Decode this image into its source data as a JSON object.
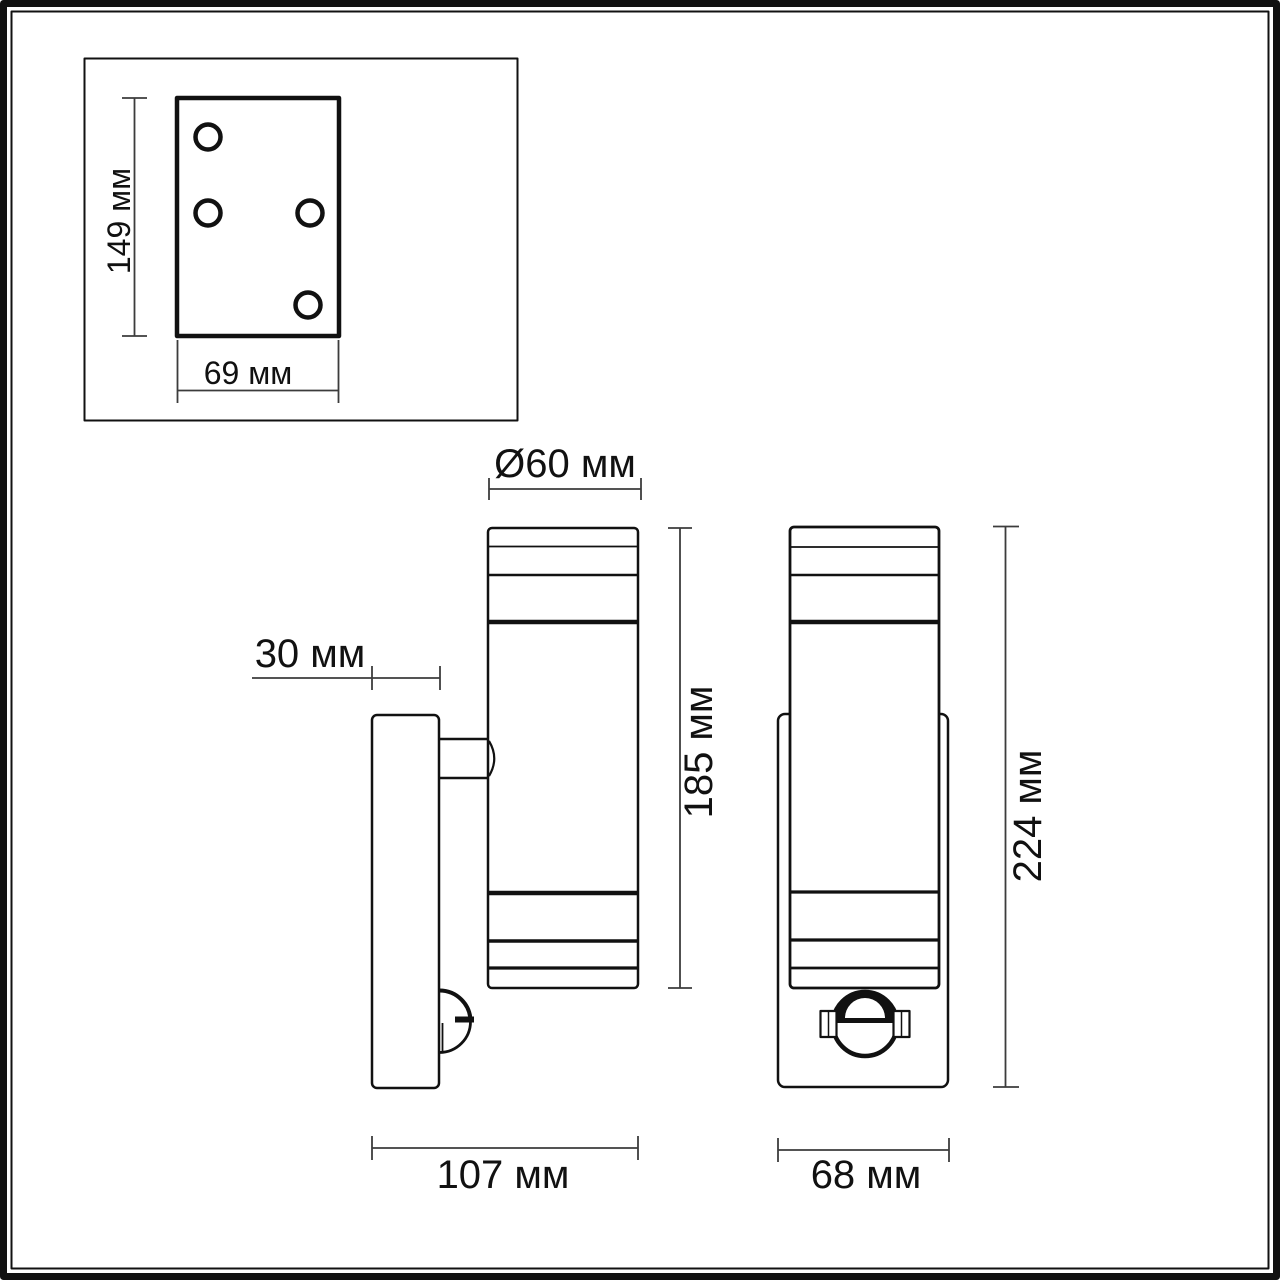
{
  "colors": {
    "line": "#111111",
    "dimension_line": "#3c3c3c",
    "text": "#111111",
    "background": "#ffffff"
  },
  "units": "мм",
  "mounting_plate_view": {
    "height_label": "149 мм",
    "width_label": "69 мм"
  },
  "side_view": {
    "diameter_label": "Ø60 мм",
    "plate_depth_label": "30 мм",
    "body_height_label": "185 мм",
    "total_depth_label": "107 мм"
  },
  "front_view": {
    "total_height_label": "224 мм",
    "width_label": "68 мм"
  }
}
